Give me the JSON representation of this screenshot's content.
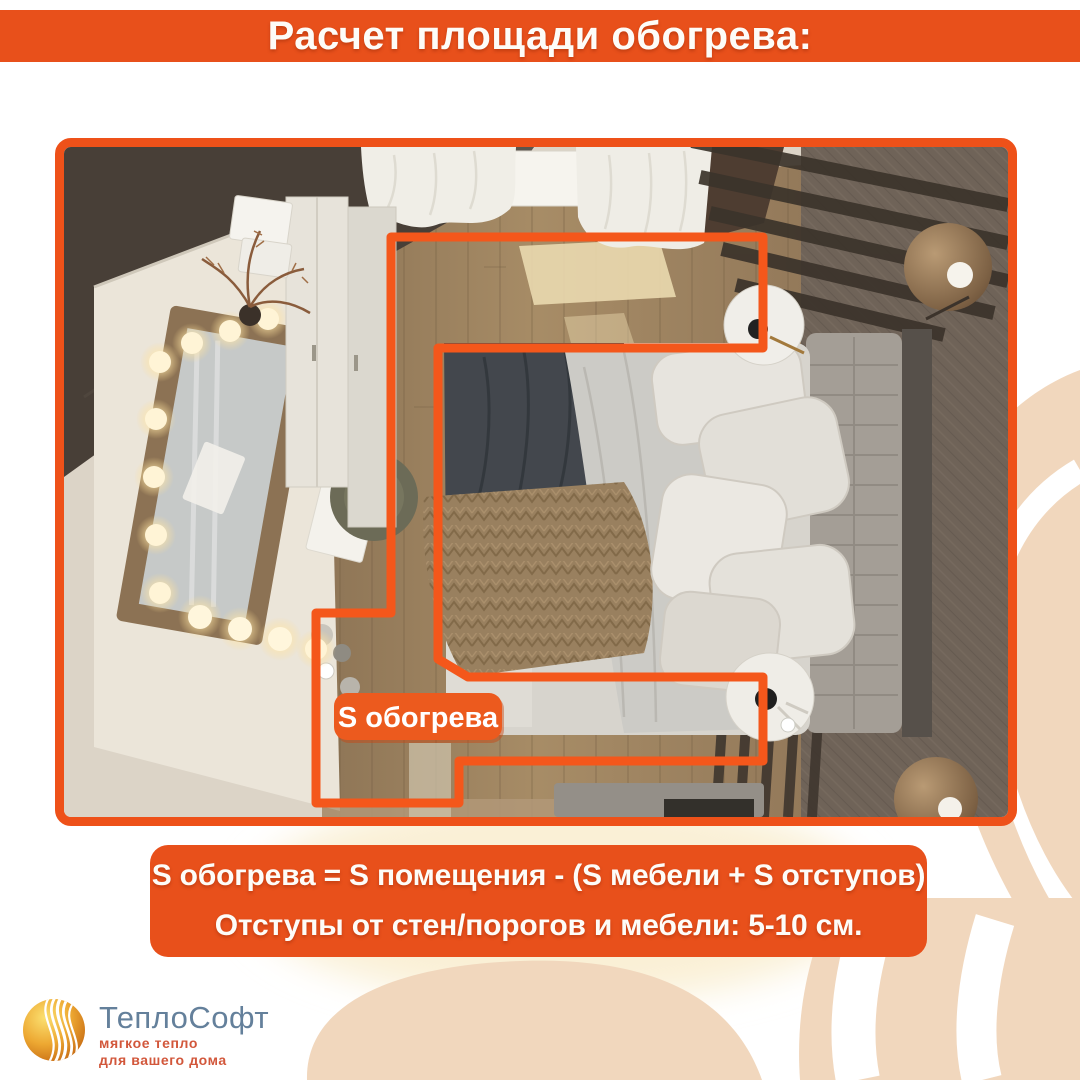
{
  "header": {
    "title": "Расчет площади обогрева:"
  },
  "diagram": {
    "area_label": "S обогрева"
  },
  "formula": {
    "line1": "S обогрева = S помещения - (S мебели + S отступов)",
    "line2": "Отступы от стен/порогов и мебели: 5-10 см."
  },
  "logo": {
    "company": "ТеплоСофт",
    "tagline1": "мягкое тепло",
    "tagline2": "для вашего дома"
  },
  "colors": {
    "accent": "#E8501B",
    "outline": "#F4571B",
    "swirl_peach": "#F1D7BD",
    "swirl_cream": "#FAF0D6",
    "logo_text": "#64809B",
    "logo_tagline": "#D2573B"
  }
}
